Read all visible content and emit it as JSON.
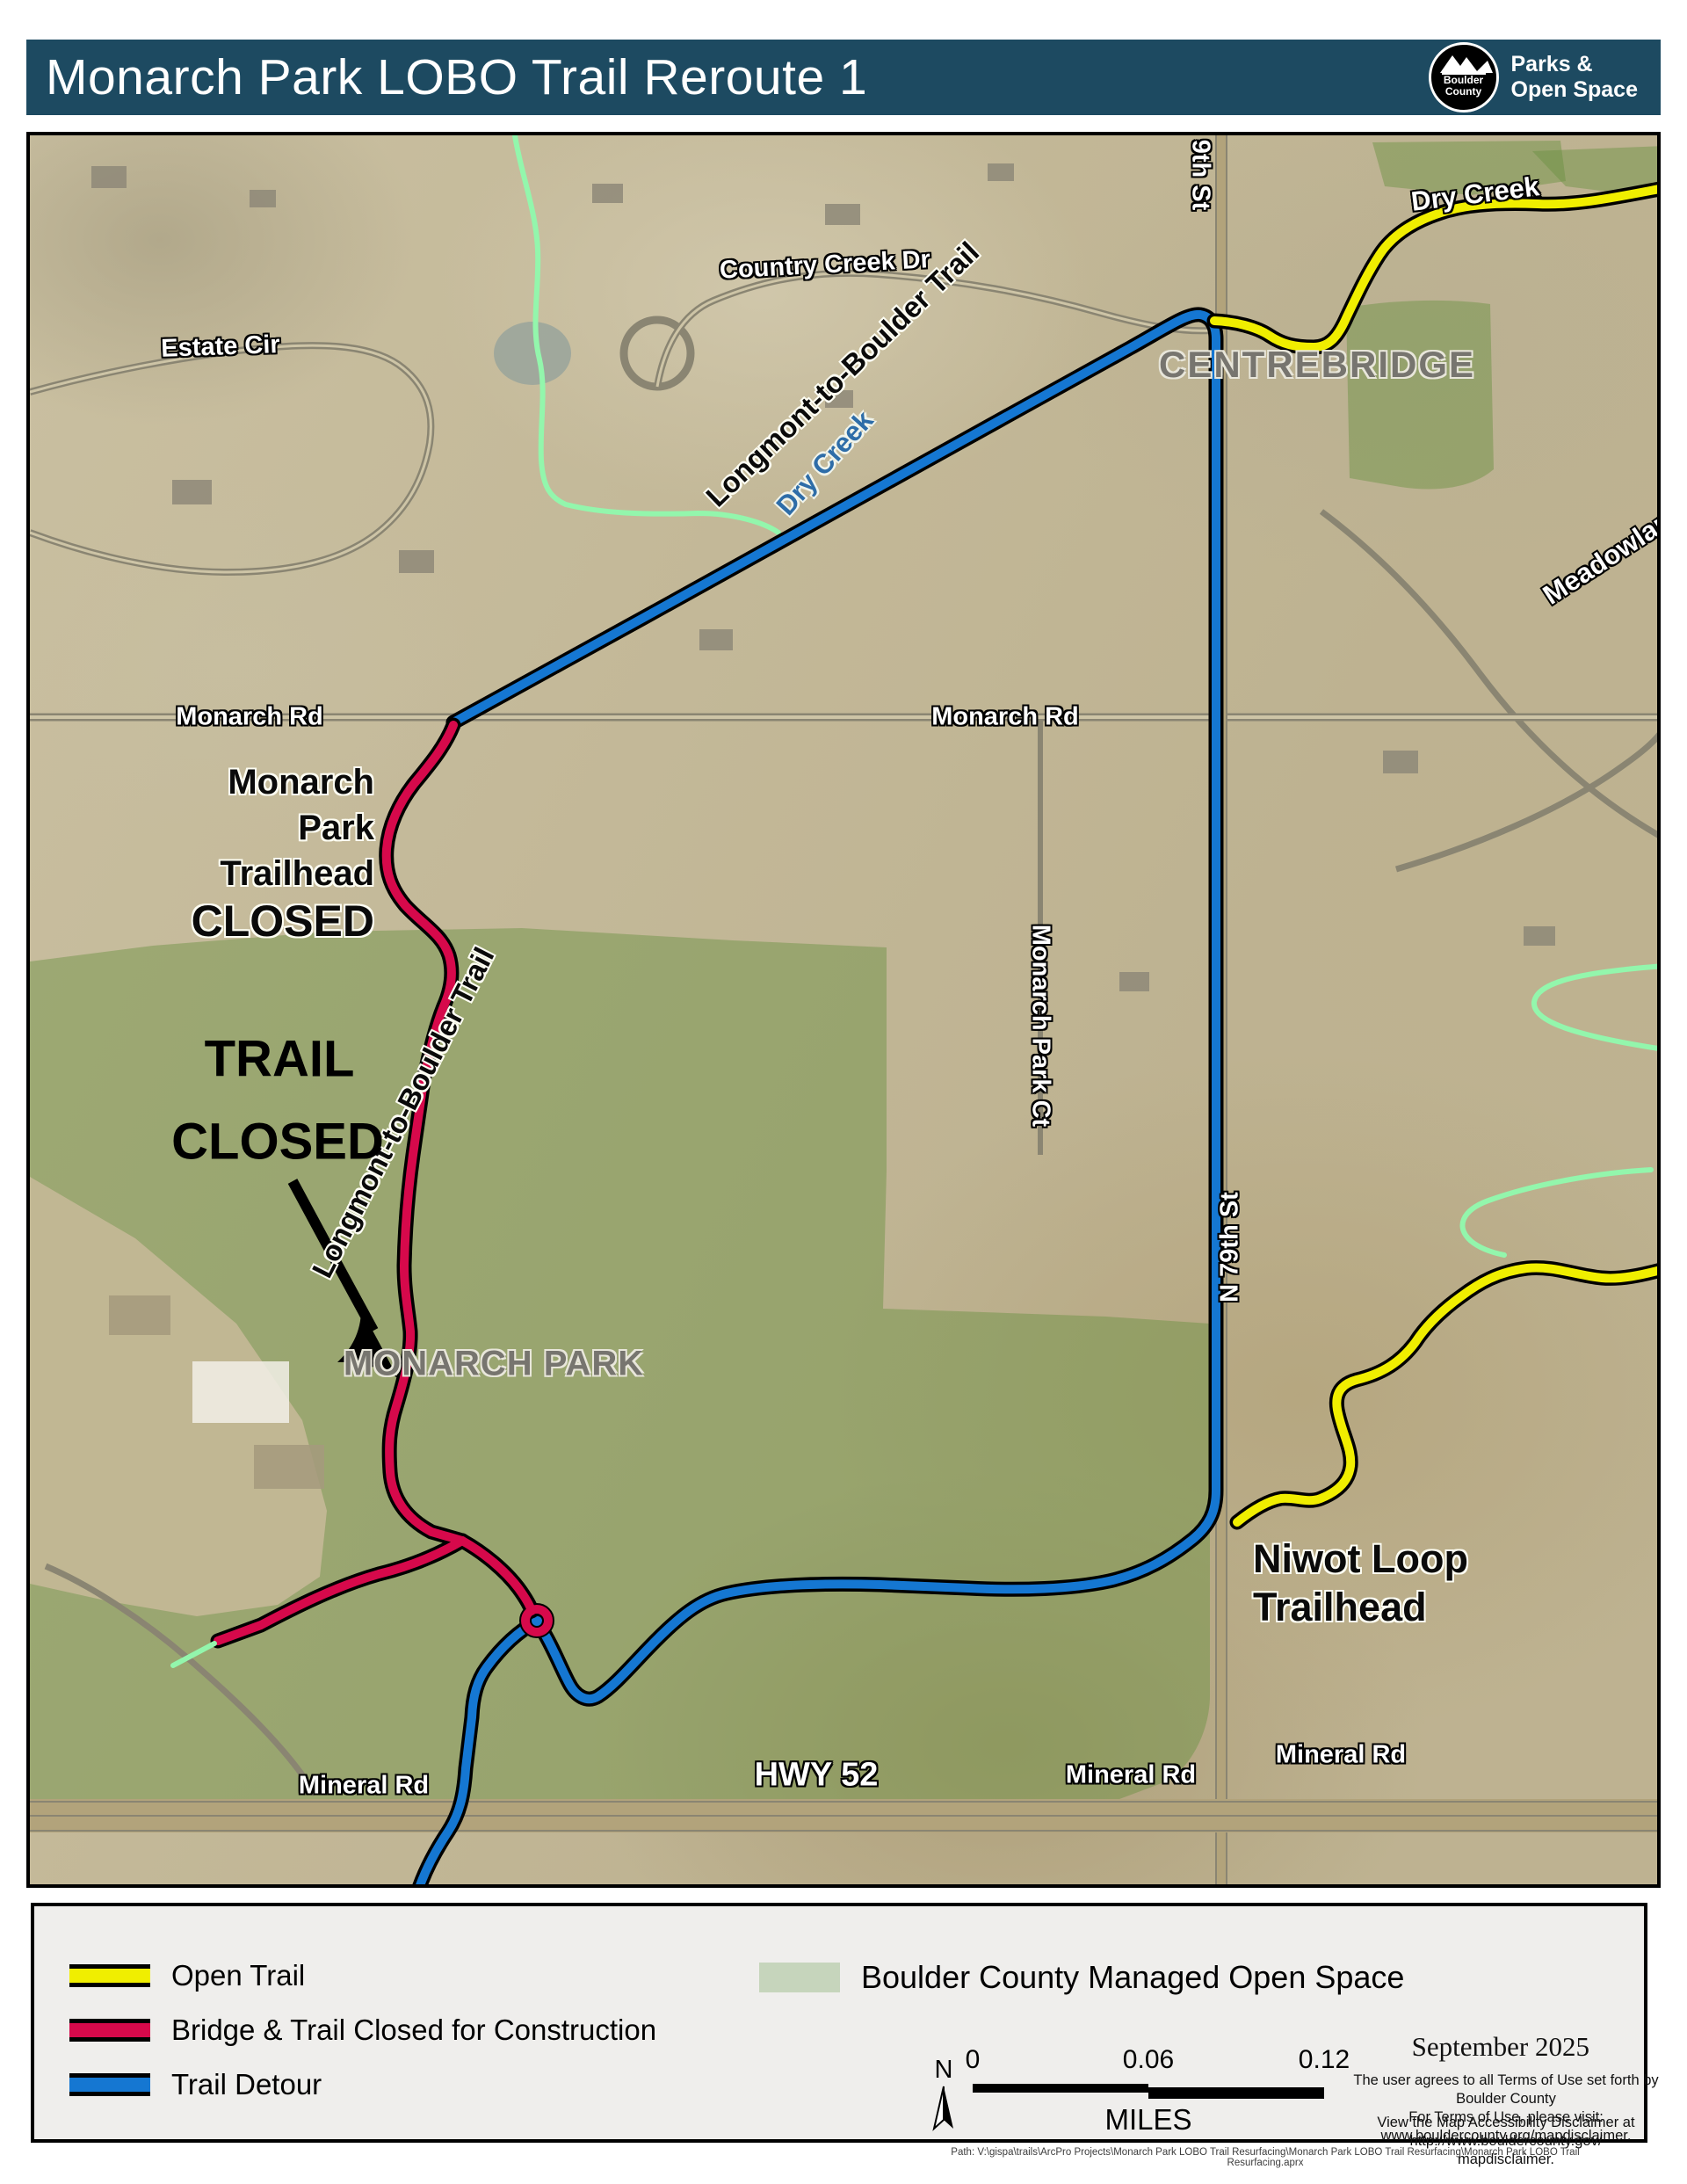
{
  "header": {
    "title": "Monarch Park LOBO Trail Reroute 1",
    "logo_line1": "Boulder",
    "logo_line2": "County",
    "agency_line1": "Parks &",
    "agency_line2": "Open Space"
  },
  "colors": {
    "header-bar": "#1d4a61",
    "trail-open": "#f0ee00",
    "trail-closed": "#d6094b",
    "trail-detour": "#1577d2",
    "open-space": "rgba(104,144,64,0.45)",
    "creek": "#93f6ac"
  },
  "map": {
    "labels": {
      "estate_cir": "Estate Cir",
      "country_creek_dr": "Country Creek Dr",
      "dry_creek_ne": "Dry Creek",
      "dry_creek_sw": "Dry Creek",
      "lobo_upper": "Longmont-to-Boulder Trail",
      "lobo_lower": "Longmont-to-Boulder Trail",
      "centrebridge": "CENTREBRIDGE",
      "meadowlark": "Meadowlark",
      "monarch_rd_left": "Monarch Rd",
      "monarch_rd_right": "Monarch Rd",
      "trailhead_line1": "Monarch Park",
      "trailhead_line2": "Trailhead",
      "trailhead_line3": "CLOSED",
      "trail_closed_line1": "TRAIL",
      "trail_closed_line2": "CLOSED",
      "monarch_park": "MONARCH PARK",
      "monarch_park_ct": "Monarch Park Ct",
      "n79th_st_top": "9th St",
      "n79th_st": "N 79th St",
      "niwot_line1": "Niwot Loop",
      "niwot_line2": "Trailhead",
      "mineral_rd_left": "Mineral Rd",
      "mineral_rd_mid": "Mineral Rd",
      "mineral_rd_right": "Mineral Rd",
      "hwy52": "HWY 52"
    }
  },
  "legend": {
    "items": [
      {
        "label": "Open Trail",
        "color": "#f0ee00"
      },
      {
        "label": "Bridge & Trail Closed for Construction",
        "color": "#d6094b"
      },
      {
        "label": "Trail Detour",
        "color": "#1577d2"
      }
    ],
    "area_item": {
      "label": "Boulder County Managed Open Space",
      "color": "#c6d5bc"
    },
    "north_label": "N",
    "scalebar": {
      "t0": "0",
      "t1": "0.06",
      "t2": "0.12",
      "units": "MILES"
    },
    "date": "September 2025",
    "disclaimer1a": "The user agrees to all Terms of Use set forth by Boulder County",
    "disclaimer1b": "For Terms of Use, please visit: www.bouldercounty.org/mapdisclaimer.",
    "disclaimer2a": "View the Map Accessibility Disclaimer at http://www.bouldercounty.gov/",
    "disclaimer2b": "mapdisclaimer."
  },
  "footer": {
    "path": "Path: V:\\gispa\\trails\\ArcPro Projects\\Monarch Park LOBO Trail Resurfacing\\Monarch Park LOBO Trail Resurfacing\\Monarch Park LOBO Trail Resurfacing.aprx"
  }
}
